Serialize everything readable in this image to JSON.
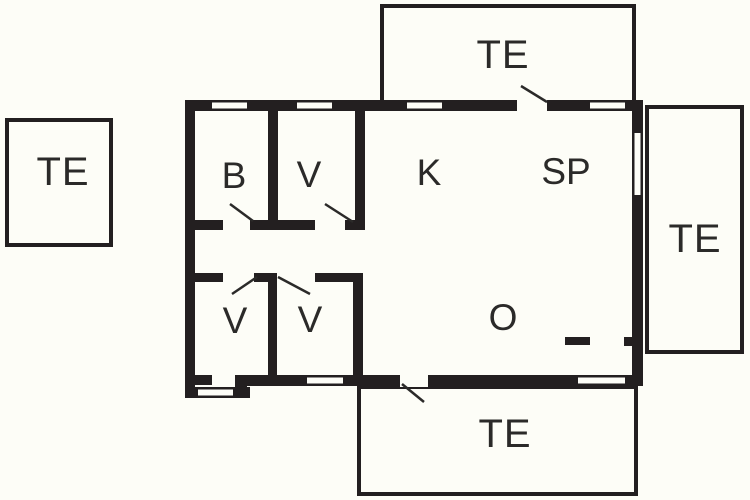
{
  "plan": {
    "type": "floor-plan",
    "colors": {
      "background": "#fdfdf7",
      "wall": "#231f20",
      "label_text": "#2b2a29"
    },
    "terraces": {
      "top": {
        "label": "TE"
      },
      "left": {
        "label": "TE"
      },
      "right": {
        "label": "TE"
      },
      "bottom": {
        "label": "TE"
      }
    },
    "rooms": {
      "b": {
        "label": "B"
      },
      "v_top": {
        "label": "V"
      },
      "k": {
        "label": "K"
      },
      "sp": {
        "label": "SP"
      },
      "o": {
        "label": "O"
      },
      "v_bottom_left": {
        "label": "V"
      },
      "v_bottom_right": {
        "label": "V"
      }
    }
  }
}
